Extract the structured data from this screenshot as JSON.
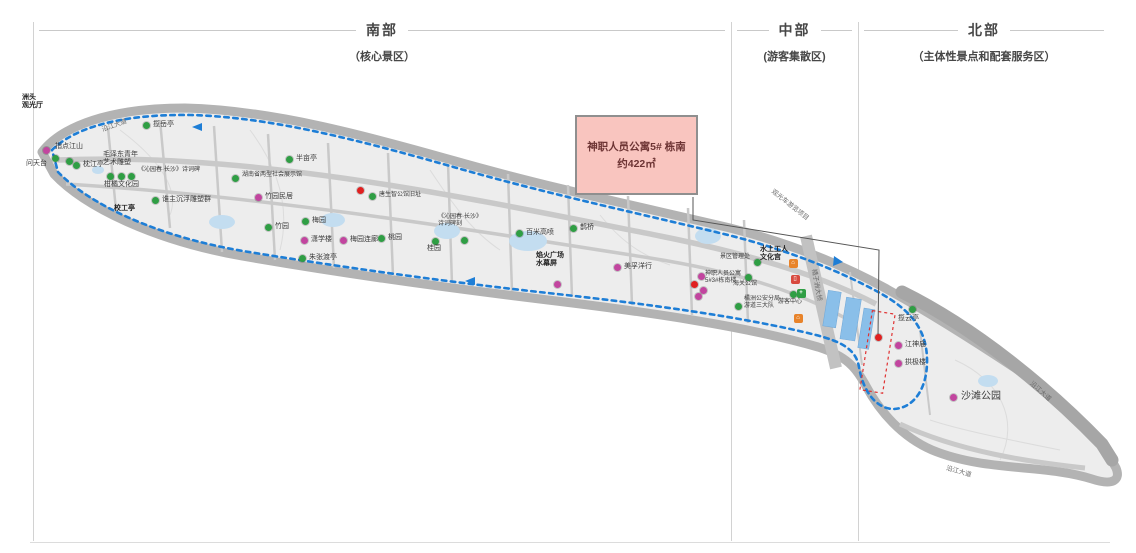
{
  "sections": [
    {
      "title": "南部",
      "subtitle": "（核心景区）"
    },
    {
      "title": "中部",
      "subtitle": "(游客集散区)"
    },
    {
      "title": "北部",
      "subtitle": "（主体性景点和配套服务区）"
    }
  ],
  "callout": {
    "line1": "神职人员公寓5# 栋南",
    "line2": "约422㎡"
  },
  "map": {
    "colors": {
      "island_fill": "#ededed",
      "shore": "#b3b3b3",
      "road": "#c9c9c9",
      "route_blue": "#1e7ed6",
      "pond": "#c3ddf0",
      "pool": "#8abfe9",
      "red_boundary": "#e03131",
      "callout_fill": "#f9c5bf",
      "dots": {
        "green": "#2f9e44",
        "magenta": "#c2459f",
        "red": "#e02020"
      }
    },
    "pois": [
      {
        "lines": [
          "洲头",
          "观光厅"
        ],
        "lx": 22,
        "ly": 94,
        "bold": true
      },
      {
        "label": "指点江山",
        "lx": 55,
        "ly": 143
      },
      {
        "label": "问天台",
        "lx": 26,
        "ly": 160
      },
      {
        "dot": "magenta",
        "x": 46,
        "y": 150
      },
      {
        "dot": "green",
        "x": 55,
        "y": 158
      },
      {
        "dot": "green",
        "x": 69,
        "y": 161
      },
      {
        "label": "枕江亭",
        "dot": "green",
        "x": 76,
        "y": 165,
        "lx": 83,
        "ly": 161
      },
      {
        "label": "揽岳亭",
        "dot": "green",
        "x": 146,
        "y": 125,
        "lx": 153,
        "ly": 121
      },
      {
        "lines": [
          "毛泽东青年",
          "艺术雕塑"
        ],
        "lx": 103,
        "ly": 151
      },
      {
        "dot": "green",
        "x": 110,
        "y": 176
      },
      {
        "dot": "green",
        "x": 121,
        "y": 176
      },
      {
        "dot": "green",
        "x": 131,
        "y": 176
      },
      {
        "label": "柑橘文化园",
        "lx": 104,
        "ly": 181
      },
      {
        "label": "《沁园春·长沙》诗词碑",
        "lx": 138,
        "ly": 167,
        "fs": 6
      },
      {
        "label": "谁主沉浮雕塑群",
        "dot": "green",
        "x": 155,
        "y": 200,
        "lx": 162,
        "ly": 196
      },
      {
        "label": "校工亭",
        "lx": 114,
        "ly": 205,
        "bold": true
      },
      {
        "label": "湖南省两型社会展示馆",
        "dot": "green",
        "x": 235,
        "y": 178,
        "lx": 242,
        "ly": 172,
        "fs": 6
      },
      {
        "label": "半亩亭",
        "dot": "green",
        "x": 289,
        "y": 159,
        "lx": 296,
        "ly": 155
      },
      {
        "label": "竹园民居",
        "dot": "magenta",
        "x": 258,
        "y": 197,
        "lx": 265,
        "ly": 193
      },
      {
        "label": "竹园",
        "dot": "green",
        "x": 268,
        "y": 227,
        "lx": 275,
        "ly": 223
      },
      {
        "label": "梅园",
        "dot": "green",
        "x": 305,
        "y": 221,
        "lx": 312,
        "ly": 217
      },
      {
        "label": "潇学楼",
        "dot": "magenta",
        "x": 304,
        "y": 240,
        "lx": 311,
        "ly": 236
      },
      {
        "label": "梅园连廊",
        "dot": "magenta",
        "x": 343,
        "y": 240,
        "lx": 350,
        "ly": 236
      },
      {
        "label": "朱张渡亭",
        "dot": "green",
        "x": 302,
        "y": 258,
        "lx": 309,
        "ly": 254
      },
      {
        "label": "桃园",
        "dot": "green",
        "x": 381,
        "y": 238,
        "lx": 388,
        "ly": 234
      },
      {
        "dot": "red",
        "x": 360,
        "y": 190
      },
      {
        "label": "唐生智公馆旧址",
        "dot": "green",
        "x": 372,
        "y": 196,
        "lx": 379,
        "ly": 192,
        "fs": 6
      },
      {
        "lines": [
          "《沁园春·长沙》",
          "诗词碑刻"
        ],
        "lx": 438,
        "ly": 214,
        "fs": 6
      },
      {
        "dot": "green",
        "x": 435,
        "y": 241
      },
      {
        "label": "桂园",
        "lx": 427,
        "ly": 245
      },
      {
        "dot": "green",
        "x": 464,
        "y": 240
      },
      {
        "label": "百米高喷",
        "dot": "green",
        "x": 519,
        "y": 233,
        "lx": 526,
        "ly": 229
      },
      {
        "label": "鹊桥",
        "dot": "green",
        "x": 573,
        "y": 228,
        "lx": 580,
        "ly": 224
      },
      {
        "lines": [
          "焰火广场",
          "水幕屏"
        ],
        "lx": 536,
        "ly": 252,
        "bold": true
      },
      {
        "dot": "magenta",
        "x": 557,
        "y": 284
      },
      {
        "label": "美孚洋行",
        "dot": "magenta",
        "x": 617,
        "y": 267,
        "lx": 624,
        "ly": 263
      },
      {
        "label": "景区管理处",
        "lx": 720,
        "ly": 254,
        "fs": 6
      },
      {
        "dot": "green",
        "x": 757,
        "y": 262
      },
      {
        "lines": [
          "水上工人",
          "文化宫"
        ],
        "lx": 760,
        "ly": 246,
        "bold": true
      },
      {
        "lines": [
          "神职人员公寓",
          "5#3#栋南楼"
        ],
        "lx": 705,
        "ly": 271,
        "fs": 6
      },
      {
        "dot": "magenta",
        "x": 701,
        "y": 276
      },
      {
        "dot": "red",
        "x": 694,
        "y": 284
      },
      {
        "dot": "magenta",
        "x": 703,
        "y": 290
      },
      {
        "dot": "magenta",
        "x": 698,
        "y": 296
      },
      {
        "label": "海关公馆",
        "dot": "green",
        "x": 748,
        "y": 277,
        "lx": 733,
        "ly": 281,
        "fs": 6
      },
      {
        "lines": [
          "橘洲公安分局",
          "游道三大队"
        ],
        "lx": 744,
        "ly": 296,
        "fs": 6
      },
      {
        "dot": "green",
        "x": 738,
        "y": 306
      },
      {
        "label": "游客中心",
        "lx": 778,
        "ly": 299,
        "fs": 6
      },
      {
        "dot": "green",
        "x": 793,
        "y": 294
      },
      {
        "label": "揽云亭",
        "dot": "green",
        "x": 912,
        "y": 309,
        "lx": 898,
        "ly": 315
      },
      {
        "label": "江神庙",
        "dot": "magenta",
        "x": 898,
        "y": 345,
        "lx": 905,
        "ly": 341
      },
      {
        "label": "拱极楼",
        "dot": "magenta",
        "x": 898,
        "y": 363,
        "lx": 905,
        "ly": 359
      },
      {
        "label": "沙滩公园",
        "dot": "magenta",
        "x": 953,
        "y": 397,
        "lx": 961,
        "ly": 391,
        "fs": 10
      },
      {
        "dot": "red",
        "x": 878,
        "y": 337
      }
    ],
    "icons": [
      {
        "glyph": "⌂",
        "color": "#e8832a",
        "x": 793,
        "y": 263,
        "name": "service-house-icon"
      },
      {
        "glyph": "▯",
        "color": "#d84a3f",
        "x": 795,
        "y": 279,
        "name": "red-service-icon"
      },
      {
        "glyph": "+",
        "color": "#2f9e44",
        "x": 801,
        "y": 293,
        "name": "medical-cross-icon"
      },
      {
        "glyph": "⌂",
        "color": "#e8832a",
        "x": 798,
        "y": 318,
        "name": "service-house-icon"
      }
    ],
    "rotated_labels": [
      {
        "text": "观光车游览项目",
        "x": 776,
        "y": 186,
        "rot": 38
      },
      {
        "text": "橘子洲大桥",
        "x": 820,
        "y": 268,
        "rot": 80
      },
      {
        "text": "沿江大道",
        "x": 1035,
        "y": 378,
        "rot": 42
      },
      {
        "text": "沿江大道",
        "x": 948,
        "y": 462,
        "rot": 16
      },
      {
        "text": "沿江大道",
        "x": 100,
        "y": 124,
        "rot": -20
      }
    ]
  }
}
